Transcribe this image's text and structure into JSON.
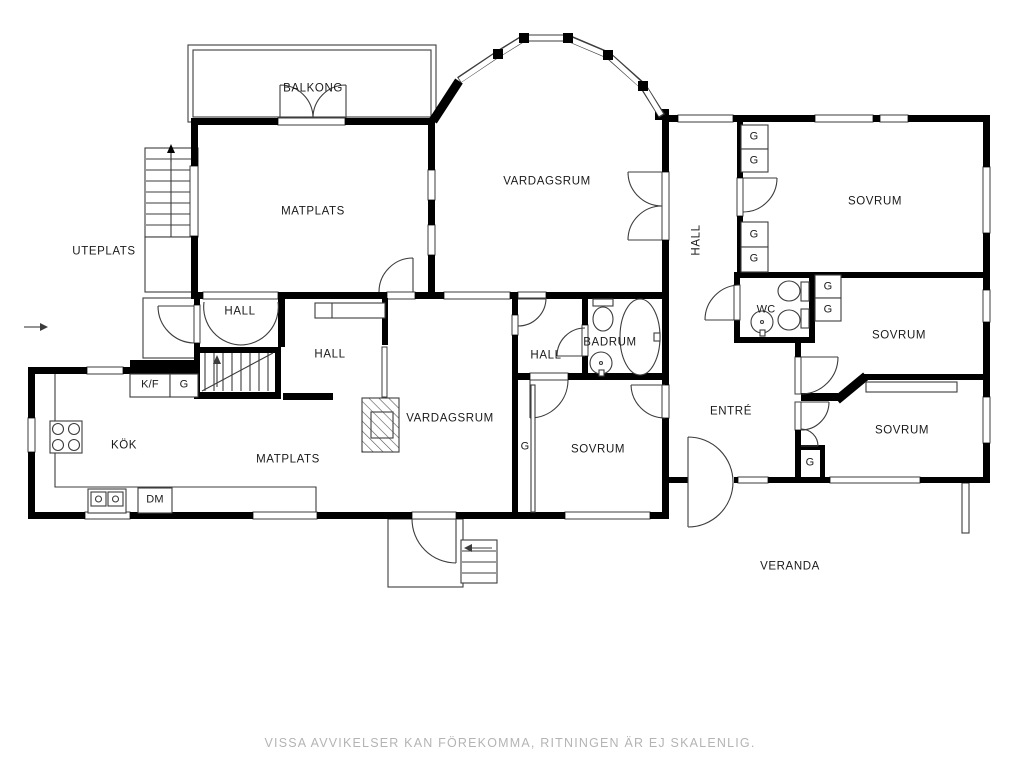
{
  "colors": {
    "wall": "#000000",
    "thin_line": "#3c3c3c",
    "text": "#1a1a1a",
    "muted_text": "#b4b4b4",
    "background": "#ffffff"
  },
  "rooms": {
    "balkong": "BALKONG",
    "matplats_ovre": "MATPLATS",
    "vardagsrum_ovre": "VARDAGSRUM",
    "hall_ovre": "HALL",
    "sovrum_nordost": "SOVRUM",
    "uteplats": "UTEPLATS",
    "hall_trapp": "HALL",
    "hall_mitt": "HALL",
    "hall_sov": "HALL",
    "badrum": "BADRUM",
    "wc": "WC",
    "sovrum_ost": "SOVRUM",
    "kok": "KÖK",
    "matplats_nedre": "MATPLATS",
    "vardagsrum_nedre": "VARDAGSRUM",
    "sovrum_mitt": "SOVRUM",
    "entre": "ENTRÉ",
    "sovrum_sydost": "SOVRUM",
    "veranda": "VERANDA"
  },
  "fixtures": {
    "garderob": "G",
    "kyl_frys": "K/F",
    "diskmaskin": "DM"
  },
  "footer": {
    "disclaimer": "VISSA AVVIKELSER KAN FÖREKOMMA, RITNINGEN ÄR EJ SKALENLIG."
  }
}
